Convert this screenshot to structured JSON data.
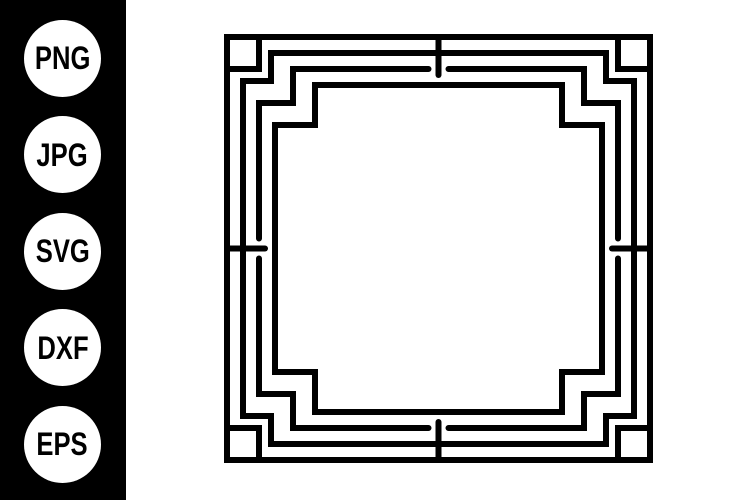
{
  "sidebar": {
    "background_color": "#000000",
    "badge_fill_color": "#ffffff",
    "badge_text_color": "#000000",
    "formats": [
      {
        "label": "PNG"
      },
      {
        "label": "JPG"
      },
      {
        "label": "SVG"
      },
      {
        "label": "DXF"
      },
      {
        "label": "EPS"
      }
    ]
  },
  "artwork": {
    "name": "art-deco-square-frame",
    "stroke_color": "#000000",
    "background_color": "#ffffff"
  }
}
